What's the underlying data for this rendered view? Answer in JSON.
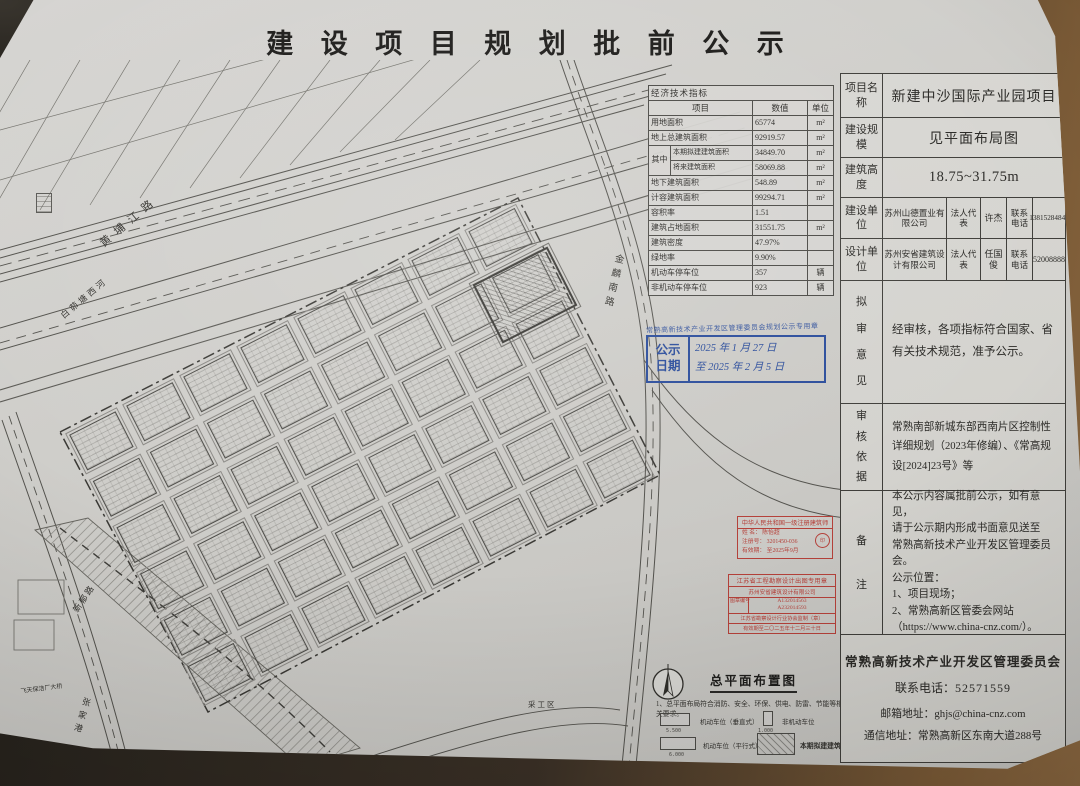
{
  "title": "建 设 项 目 规 划 批 前 公 示",
  "indicators": {
    "title": "经济技术指标",
    "col_item": "项目",
    "col_value": "数值",
    "col_unit": "单位",
    "merge_label": "其中",
    "rows": [
      {
        "label": "用地面积",
        "value": "65774",
        "unit": "m²"
      },
      {
        "label": "地上总建筑面积",
        "value": "92919.57",
        "unit": "m²"
      },
      {
        "label": "本期拟建建筑面积",
        "value": "34849.70",
        "unit": "m²"
      },
      {
        "label": "将来建筑面积",
        "value": "58069.88",
        "unit": "m²"
      },
      {
        "label": "地下建筑面积",
        "value": "548.89",
        "unit": "m²"
      },
      {
        "label": "计容建筑面积",
        "value": "99294.71",
        "unit": "m²"
      },
      {
        "label": "容积率",
        "value": "1.51",
        "unit": ""
      },
      {
        "label": "建筑占地面积",
        "value": "31551.75",
        "unit": "m²"
      },
      {
        "label": "建筑密度",
        "value": "47.97%",
        "unit": ""
      },
      {
        "label": "绿地率",
        "value": "9.90%",
        "unit": ""
      },
      {
        "label": "机动车停车位",
        "value": "357",
        "unit": "辆"
      },
      {
        "label": "非机动车停车位",
        "value": "923",
        "unit": "辆"
      }
    ]
  },
  "info": {
    "project_name_label": "项目名称",
    "project_name": "新建中沙国际产业园项目",
    "scale_label": "建设规模",
    "scale": "见平面布局图",
    "height_label": "建筑高度",
    "height": "18.75~31.75m",
    "builder_label": "建设单位",
    "builder": "苏州山德置业有限公司",
    "legal_label": "法人代表",
    "builder_rep": "许杰",
    "phone_label": "联系电话",
    "builder_phone": "13815284841",
    "designer_label": "设计单位",
    "designer": "苏州安省建筑设计有限公司",
    "designer_rep": "任国俊",
    "designer_phone": "52008888",
    "review_label": "拟审意见",
    "review_text": "经审核，各项指标符合国家、省有关技术规范，准予公示。",
    "basis_label": "审核依据",
    "basis_text": "常熟南部新城东部西南片区控制性详细规划（2023年修编）、《常高规设[2024]23号》等",
    "remark_label": "备注",
    "remark_lines": [
      "本公示内容属批前公示，如有意见，",
      "请于公示期内形成书面意见送至",
      "常熟高新技术产业开发区管理委员会。",
      "公示位置：",
      "1、项目现场；",
      "2、常熟高新区管委会网站",
      "（https://www.china-cnz.com/）。"
    ]
  },
  "footer": {
    "org": "常熟高新技术产业开发区管理委员会",
    "phone_label": "联系电话：",
    "phone": "52571559",
    "email_label": "邮箱地址：",
    "email": "ghjs@china-cnz.com",
    "address_label": "通信地址：",
    "address": "常熟高新区东南大道288号"
  },
  "blue_stamp": {
    "agency": "常熟高新技术产业开发区管理委员会规划公示专用章",
    "label_top": "公示",
    "label_bottom": "日期",
    "line1": "2025 年 1 月 27 日",
    "line2": "至 2025 年 2 月 5 日"
  },
  "red_stamp_architect": {
    "title": "中华人民共和国一级注册建筑师",
    "name_label": "姓 名：",
    "name": "陈怡超",
    "reg_label": "注册号：",
    "reg_no": "3201450-036",
    "valid_label": "有效期：",
    "valid": "至2025年9月"
  },
  "red_stamp_design": {
    "title": "江苏省工程勘察设计出图专用章",
    "company": "苏州安省建筑设计有限公司",
    "no_label": "图章编号",
    "no1": "A132014563",
    "no2": "A232014593",
    "issuer": "江苏省勘察设计行业协会监制（章）",
    "valid": "有效期至二〇二五年十二月三十日"
  },
  "map": {
    "labels": {
      "huangpujiang": "黄埔江路",
      "baimaotang": "白茆塘西河",
      "jinlin": "金麟南路",
      "xinyu": "新郁路",
      "zhangjiagang": "张家港",
      "shuinidi": "水泥地",
      "caigongqu": "采工区",
      "bridge": "飞天保洁厂大桥"
    },
    "legend": {
      "plan_title": "总平面布置图",
      "note": "1、总平面布局符合消防、安全、环保、供电、防雷、节能等相关要求。",
      "item_vertical": "机动车位（垂直式）",
      "dim_vertical": "5.500",
      "item_nonmotor": "非机动车位",
      "dim_nonmotor": "1.000",
      "item_parallel": "机动车位（平行式）",
      "dim_parallel": "6.000",
      "item_planned": "本期拟建建筑"
    },
    "colors": {
      "stamp_blue": "#2a4c9b",
      "stamp_red": "#b5413a"
    }
  }
}
